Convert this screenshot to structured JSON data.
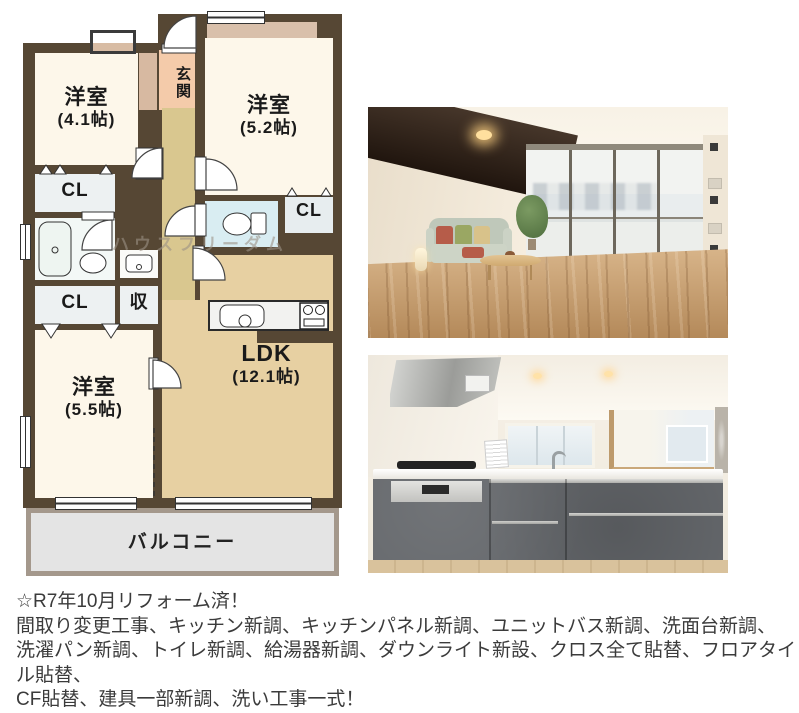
{
  "floorplan": {
    "watermark": "ハウスフリーダム",
    "rooms": {
      "west41": {
        "name": "洋室",
        "size": "(4.1帖)"
      },
      "west52": {
        "name": "洋室",
        "size": "(5.2帖)"
      },
      "west55": {
        "name": "洋室",
        "size": "(5.5帖)"
      },
      "ldk": {
        "name": "LDK",
        "size": "(12.1帖)"
      }
    },
    "labels": {
      "entrance": "玄関",
      "closet": "CL",
      "storage": "収",
      "balcony": "バルコニー"
    }
  },
  "notes": {
    "line1": "☆R7年10月リフォーム済！",
    "line2": "間取り変更工事、キッチン新調、キッチンパネル新調、ユニットバス新調、洗面台新調、",
    "line3": "洗濯パン新調、トイレ新調、給湯器新調、ダウンライト新設、クロス全て貼替、フロアタイル貼替、",
    "line4": "CF貼替、建具一部新調、洗い工事一式！"
  },
  "colors": {
    "wall": "#564734",
    "room_cream": "#fdf7ea",
    "ldk_tan": "#e7d0a2",
    "hall_yellow": "#d9c78f",
    "entrance_salmon": "#f4cbaa",
    "toilet_blue": "#d9edf2",
    "closet_gray": "#edf1f2",
    "balcony_gray": "#e4e4e4"
  }
}
